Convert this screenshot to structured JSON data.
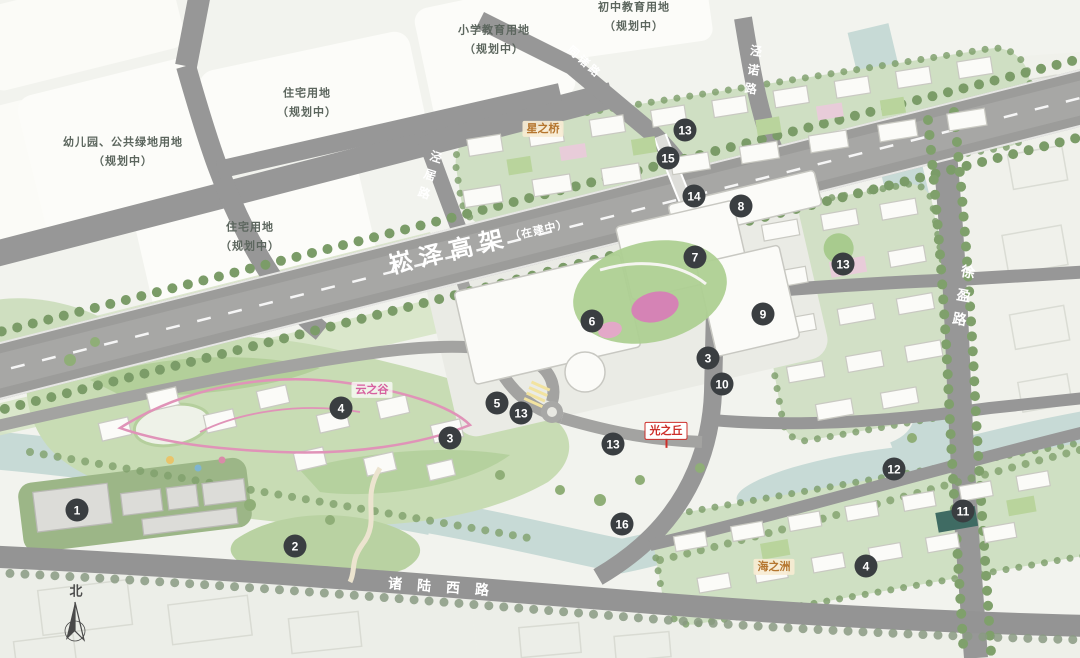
{
  "colors": {
    "background": "#f2f3ee",
    "road": "#979797",
    "highway": "#9c9c9a",
    "water": "#c7dad6",
    "park_green": "#c8dcb4",
    "residential_green": "#d2e0c6",
    "marker_bg": "#3a3e41",
    "marker_text": "#ffffff",
    "label_red": "#cd2f2a",
    "label_pink": "#d6619f",
    "label_amber": "#b5762f"
  },
  "compass": {
    "label": "北",
    "x": 76,
    "y": 590
  },
  "parcels": [
    {
      "lines": [
        "幼儿园、公共绿地用地",
        "（规划中）"
      ],
      "x": 123,
      "y": 152
    },
    {
      "lines": [
        "住宅用地",
        "（规划中）"
      ],
      "x": 307,
      "y": 103
    },
    {
      "lines": [
        "住宅用地",
        "（规划中）"
      ],
      "x": 250,
      "y": 237
    },
    {
      "lines": [
        "小学教育用地",
        "（规划中）"
      ],
      "x": 494,
      "y": 40
    },
    {
      "lines": [
        "初中教育用地",
        "（规划中）"
      ],
      "x": 634,
      "y": 17
    }
  ],
  "road_labels": [
    {
      "text": "崧泽高架",
      "suffix": "（在建中）",
      "x": 478,
      "y": 242,
      "rot": -13.5,
      "style": "highway"
    },
    {
      "text": "同诸路",
      "x": 585,
      "y": 62,
      "rot": 42,
      "style": "small"
    },
    {
      "text": "泾诺路",
      "x": 753,
      "y": 73,
      "rot": 8,
      "style": "vertical"
    },
    {
      "text": "泾居路",
      "x": 429,
      "y": 178,
      "rot": 18,
      "style": "vertical"
    },
    {
      "text": "徐盈路",
      "x": 963,
      "y": 300,
      "rot": 10,
      "style": "vertical-large"
    },
    {
      "text": "诸陆西路",
      "x": 446,
      "y": 587,
      "rot": 4,
      "style": "wide"
    }
  ],
  "place_labels": [
    {
      "text": "星之桥",
      "x": 543,
      "y": 129,
      "style": "amber"
    },
    {
      "text": "云之谷",
      "x": 372,
      "y": 390,
      "style": "pink"
    },
    {
      "text": "光之丘",
      "x": 666,
      "y": 431,
      "style": "red"
    },
    {
      "text": "海之洲",
      "x": 774,
      "y": 567,
      "style": "amber"
    }
  ],
  "markers": [
    {
      "n": "1",
      "x": 77,
      "y": 510
    },
    {
      "n": "2",
      "x": 295,
      "y": 546
    },
    {
      "n": "3",
      "x": 450,
      "y": 438
    },
    {
      "n": "3",
      "x": 708,
      "y": 358
    },
    {
      "n": "4",
      "x": 341,
      "y": 408
    },
    {
      "n": "4",
      "x": 866,
      "y": 566
    },
    {
      "n": "5",
      "x": 497,
      "y": 403
    },
    {
      "n": "6",
      "x": 592,
      "y": 321
    },
    {
      "n": "7",
      "x": 695,
      "y": 257
    },
    {
      "n": "8",
      "x": 741,
      "y": 206
    },
    {
      "n": "9",
      "x": 763,
      "y": 314
    },
    {
      "n": "10",
      "x": 722,
      "y": 384
    },
    {
      "n": "11",
      "x": 963,
      "y": 511
    },
    {
      "n": "12",
      "x": 894,
      "y": 469
    },
    {
      "n": "13",
      "x": 685,
      "y": 130
    },
    {
      "n": "13",
      "x": 843,
      "y": 264
    },
    {
      "n": "13",
      "x": 521,
      "y": 413
    },
    {
      "n": "13",
      "x": 613,
      "y": 444
    },
    {
      "n": "14",
      "x": 694,
      "y": 196
    },
    {
      "n": "15",
      "x": 668,
      "y": 158
    },
    {
      "n": "16",
      "x": 622,
      "y": 524
    }
  ]
}
